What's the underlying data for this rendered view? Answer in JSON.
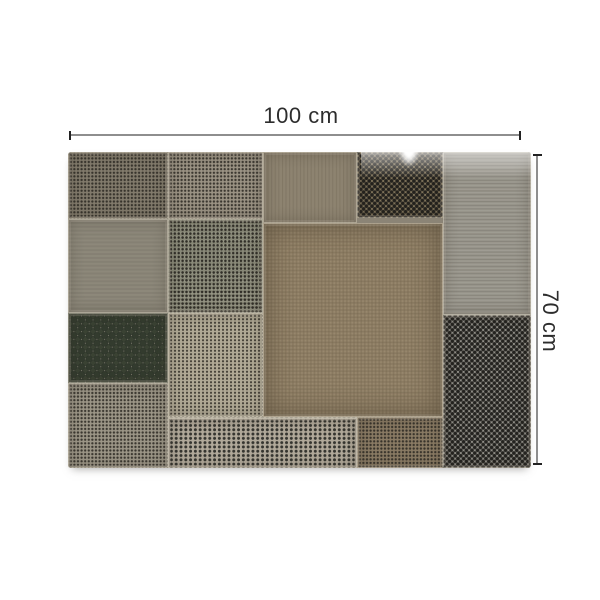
{
  "page": {
    "background_color": "#ffffff",
    "content": "product dimension diagram of a patchwork of perforated metal panels"
  },
  "annotations": {
    "width": {
      "label": "100 cm"
    },
    "height": {
      "label": "70 cm"
    },
    "line_color": "#8e8e8e",
    "tick_color": "#222222",
    "label_color": "#2d2d2d"
  },
  "product": {
    "description": "rectangular collage of riveted perforated metal sheets in gray, beige and rust-brown tones",
    "palette": {
      "gray_brown": "#827b6c",
      "light_gray": "#9b9384",
      "warm_brown": "#8a7a61",
      "beige": "#b0a995",
      "silver": "#b1a99a",
      "dark_hole": "#333b2e",
      "seam_metal": "#cac3b3"
    },
    "panels": [
      "top-left-fine-mesh",
      "top-light-gray-mesh",
      "top-brown-mesh",
      "top-dark-dot-panel",
      "right-upper-streaked-panel",
      "right-lower-dot-panel",
      "mid-left-banded-panel",
      "mid-center-left-panel",
      "large-center-brown-panel",
      "big-hole-grid-panel",
      "beige-fine-panel",
      "bottom-left-mesh",
      "bottom-silver-dot-panel",
      "bottom-brown-mesh"
    ]
  }
}
